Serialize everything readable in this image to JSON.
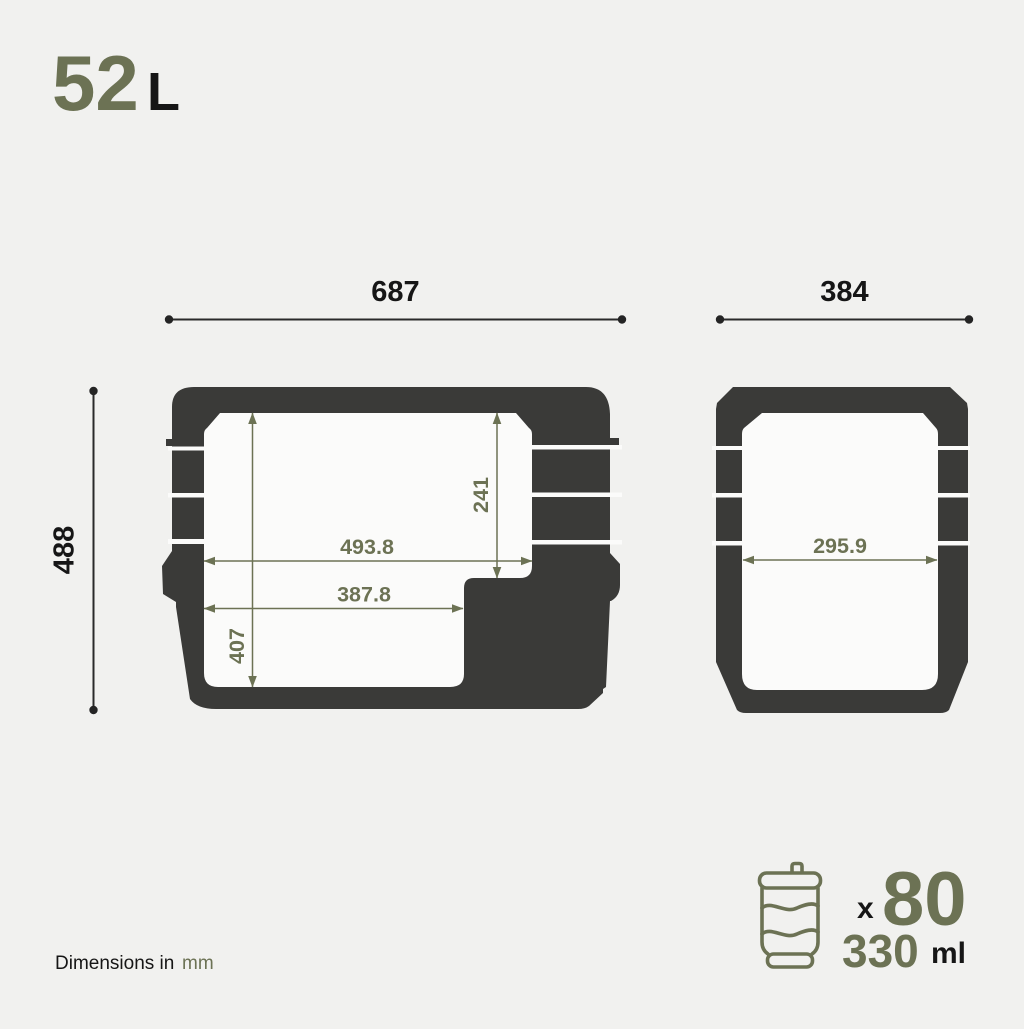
{
  "title": {
    "value": "52",
    "unit": "L"
  },
  "dimensions": {
    "side_overall_width": "687",
    "end_overall_width": "384",
    "overall_height": "488",
    "side_cavity_top_width": "493.8",
    "side_cavity_bottom_width": "387.8",
    "side_cavity_right_depth": "241",
    "side_cavity_left_depth": "407",
    "end_cavity_width": "295.9"
  },
  "capacity": {
    "multiplier": "x",
    "can_count": "80",
    "can_volume": "330",
    "can_volume_unit": "ml"
  },
  "footer": {
    "label": "Dimensions in",
    "unit": "mm"
  },
  "icons": {
    "can_icon": "beverage-can-outline"
  },
  "colors": {
    "background": "#f1f1ef",
    "shape_dark": "#3a3a38",
    "accent_olive": "#6c7254",
    "ink": "#161616"
  }
}
